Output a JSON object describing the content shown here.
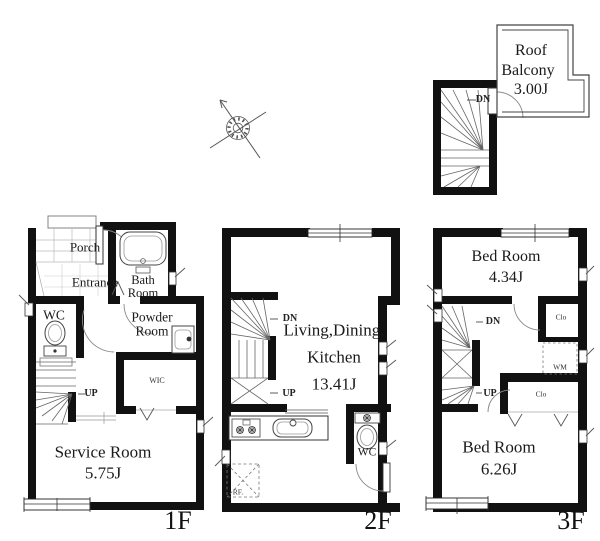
{
  "title": "3-story house floor plan",
  "colors": {
    "wall": "#111111",
    "fixture_line": "#555555",
    "thin_line": "#888888",
    "text": "#1a1a1a",
    "background": "#ffffff"
  },
  "roof": {
    "name1": "Roof",
    "name2": "Balcony",
    "area": "3.00J",
    "dn": "DN"
  },
  "f1": {
    "floor": "1F",
    "porch": "Porch",
    "entrance": "Entrance",
    "bath1": "Bath",
    "bath2": "Room",
    "wc": "WC",
    "powder1": "Powder",
    "powder2": "Room",
    "wic": "WIC",
    "up": "UP",
    "service": "Service Room",
    "service_area": "5.75J"
  },
  "f2": {
    "floor": "2F",
    "dn": "DN",
    "up": "UP",
    "ldk1": "Living,Dining,",
    "ldk2": "Kitchen",
    "ldk_area": "13.41J",
    "wc": "WC",
    "rf": "RF."
  },
  "f3": {
    "floor": "3F",
    "dn": "DN",
    "up": "UP",
    "bed1": "Bed Room",
    "bed1_area": "4.34J",
    "clo1": "Clo",
    "wm": "WM",
    "clo2": "Clo",
    "bed2": "Bed Room",
    "bed2_area": "6.26J"
  }
}
